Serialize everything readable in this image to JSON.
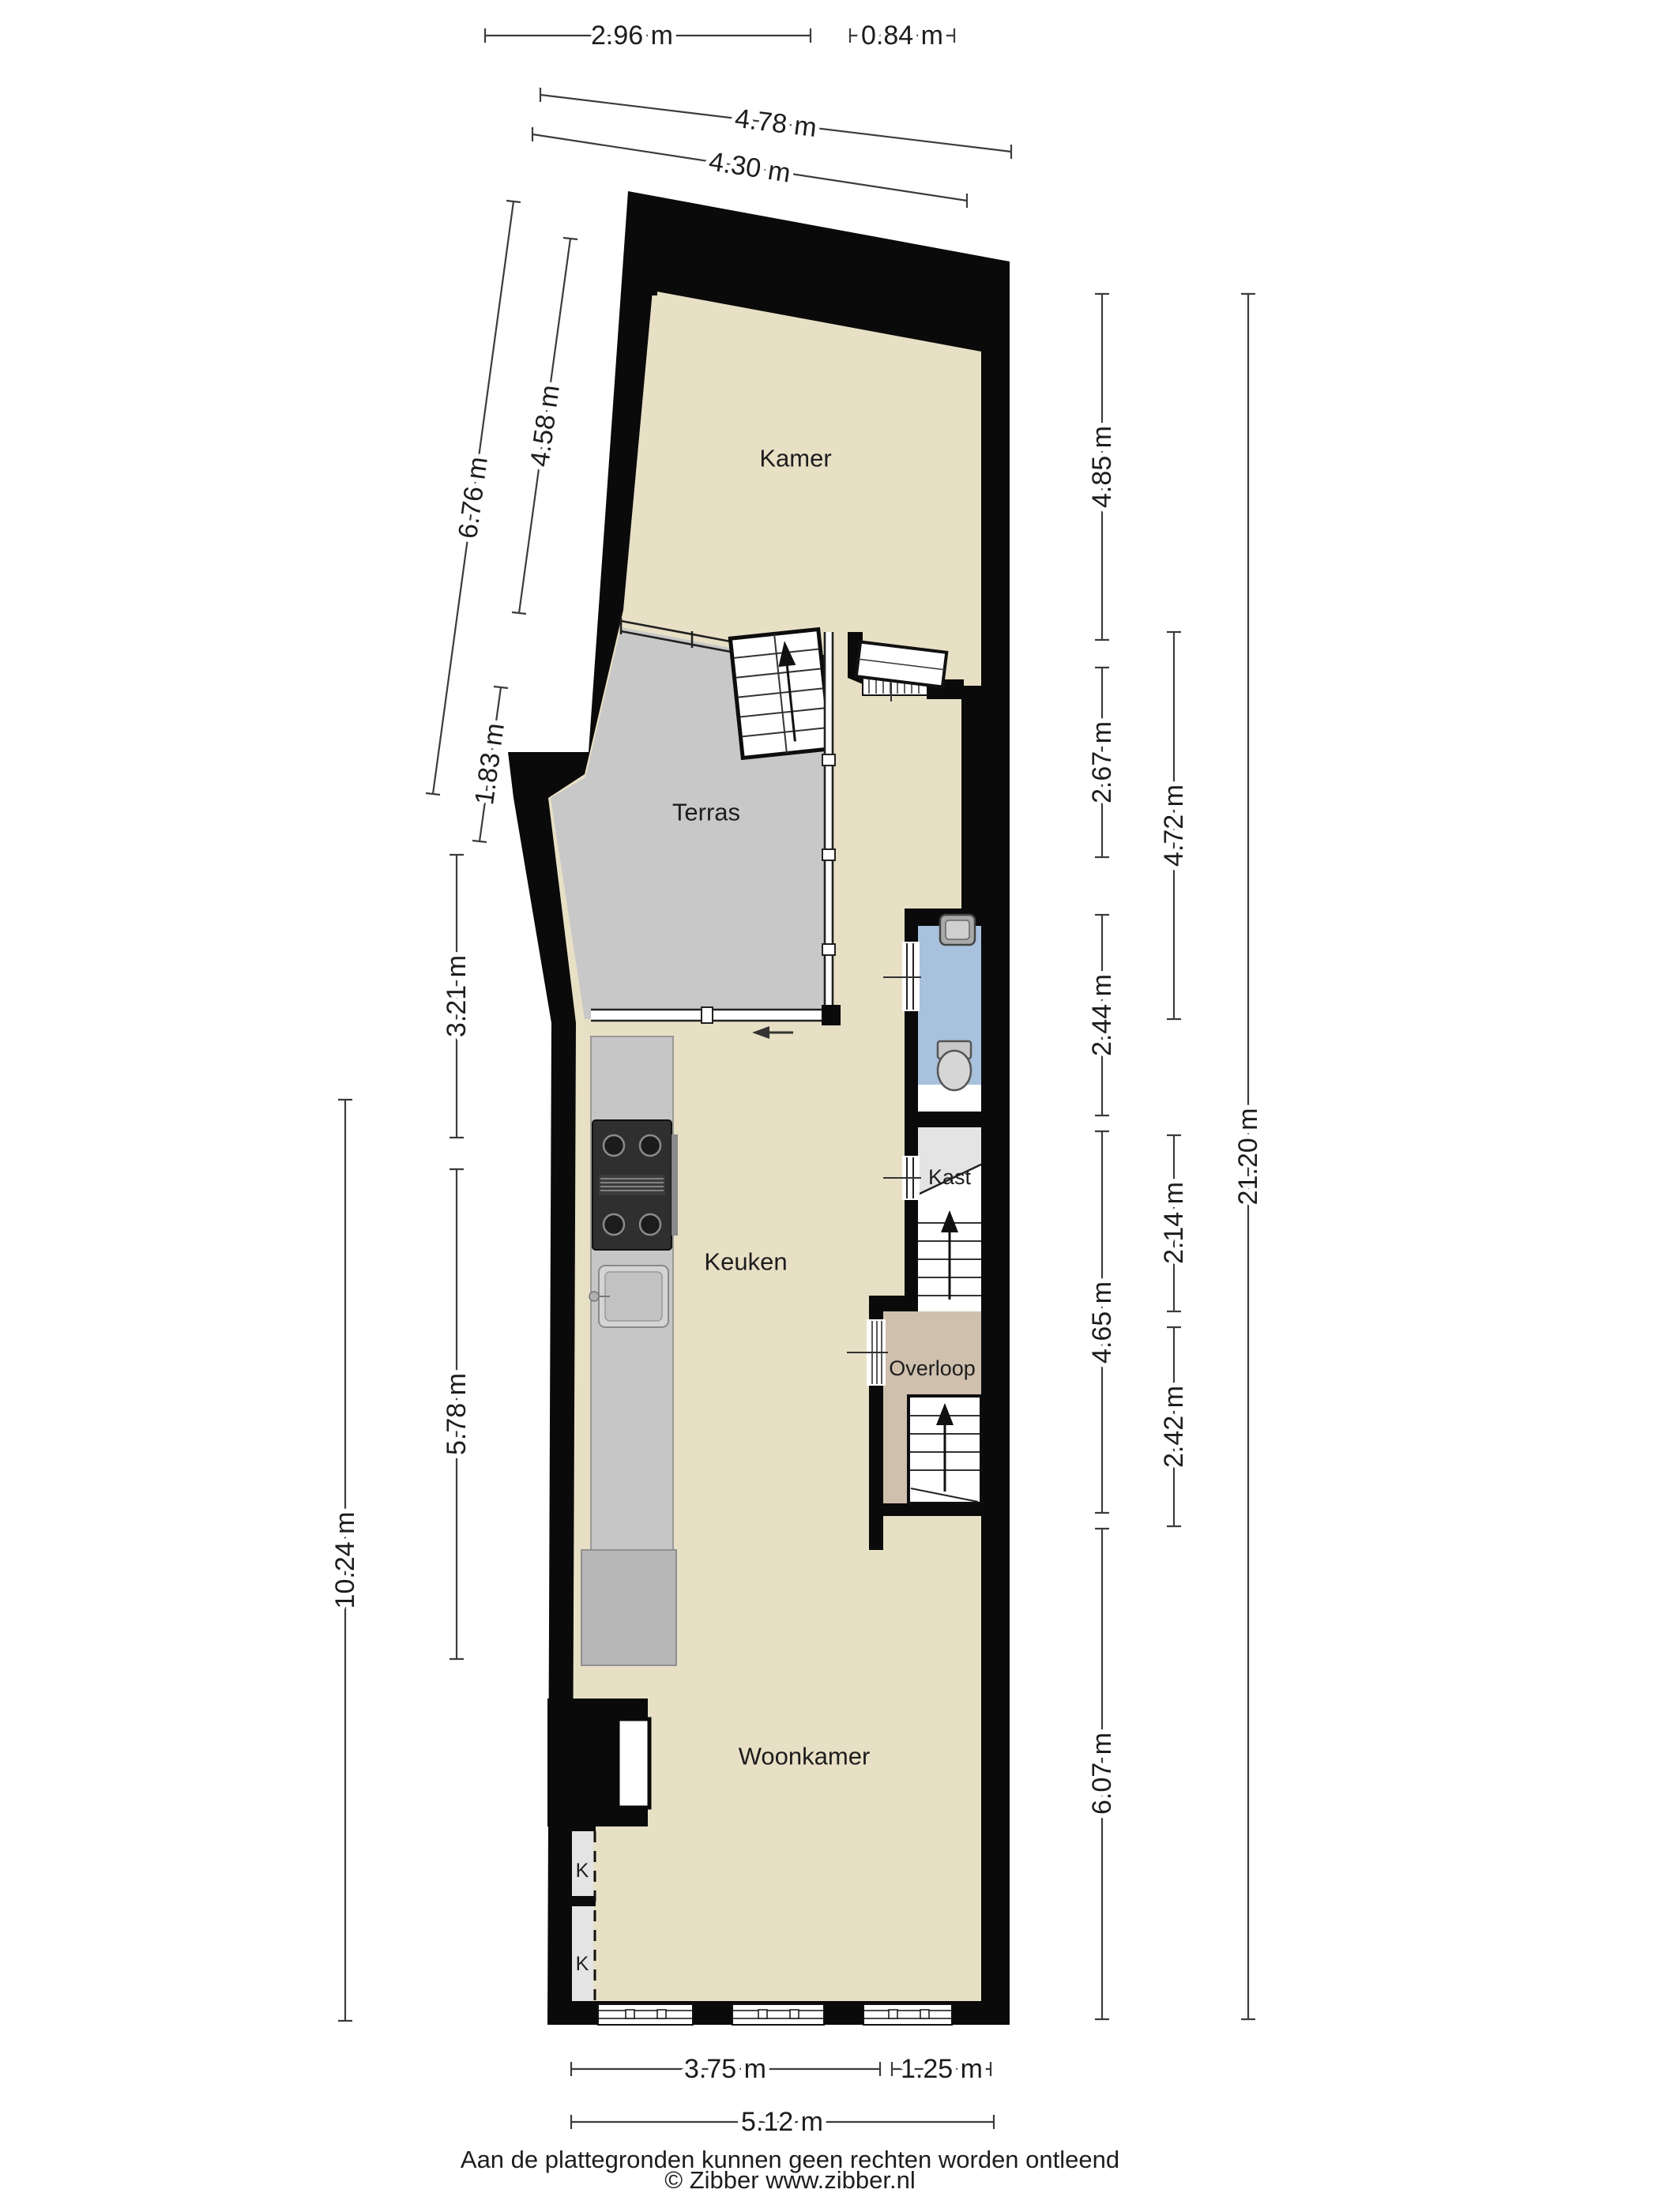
{
  "plan": {
    "rooms": [
      {
        "id": "kamer",
        "label": "Kamer"
      },
      {
        "id": "terras",
        "label": "Terras"
      },
      {
        "id": "keuken",
        "label": "Keuken"
      },
      {
        "id": "kast",
        "label": "Kast"
      },
      {
        "id": "overloop",
        "label": "Overloop"
      },
      {
        "id": "woonkamer",
        "label": "Woonkamer"
      }
    ],
    "closet_labels": [
      "K",
      "K"
    ],
    "dimensions": {
      "top": [
        {
          "label": "2.96 m"
        },
        {
          "label": "0.84 m"
        },
        {
          "label": "4.78 m"
        },
        {
          "label": "4.30 m"
        }
      ],
      "left": [
        {
          "label": "6.76 m"
        },
        {
          "label": "4.58 m"
        },
        {
          "label": "1.83 m"
        },
        {
          "label": "3.21 m"
        },
        {
          "label": "5.78 m"
        },
        {
          "label": "10.24 m"
        }
      ],
      "right": [
        {
          "label": "4.85 m"
        },
        {
          "label": "2.67 m"
        },
        {
          "label": "2.44 m"
        },
        {
          "label": "4.65 m"
        },
        {
          "label": "6.07 m"
        },
        {
          "label": "4.72 m"
        },
        {
          "label": "2.14 m"
        },
        {
          "label": "2.42 m"
        },
        {
          "label": "21.20 m"
        }
      ],
      "bottom": [
        {
          "label": "3.75 m"
        },
        {
          "label": "1.25 m"
        },
        {
          "label": "5.12 m"
        }
      ]
    },
    "colors": {
      "wall": "#0a0a0a",
      "floor": "#e8e0c5",
      "terrace": "#c8c8c8",
      "landing": "#cfc0ae",
      "bathroom": "#a8c1dc",
      "counter": "#c6c6c6",
      "closet": "#e4e4e4"
    }
  },
  "footer": {
    "disclaimer": "Aan de plattegronden kunnen geen rechten worden ontleend",
    "copyright": "© Zibber www.zibber.nl"
  }
}
